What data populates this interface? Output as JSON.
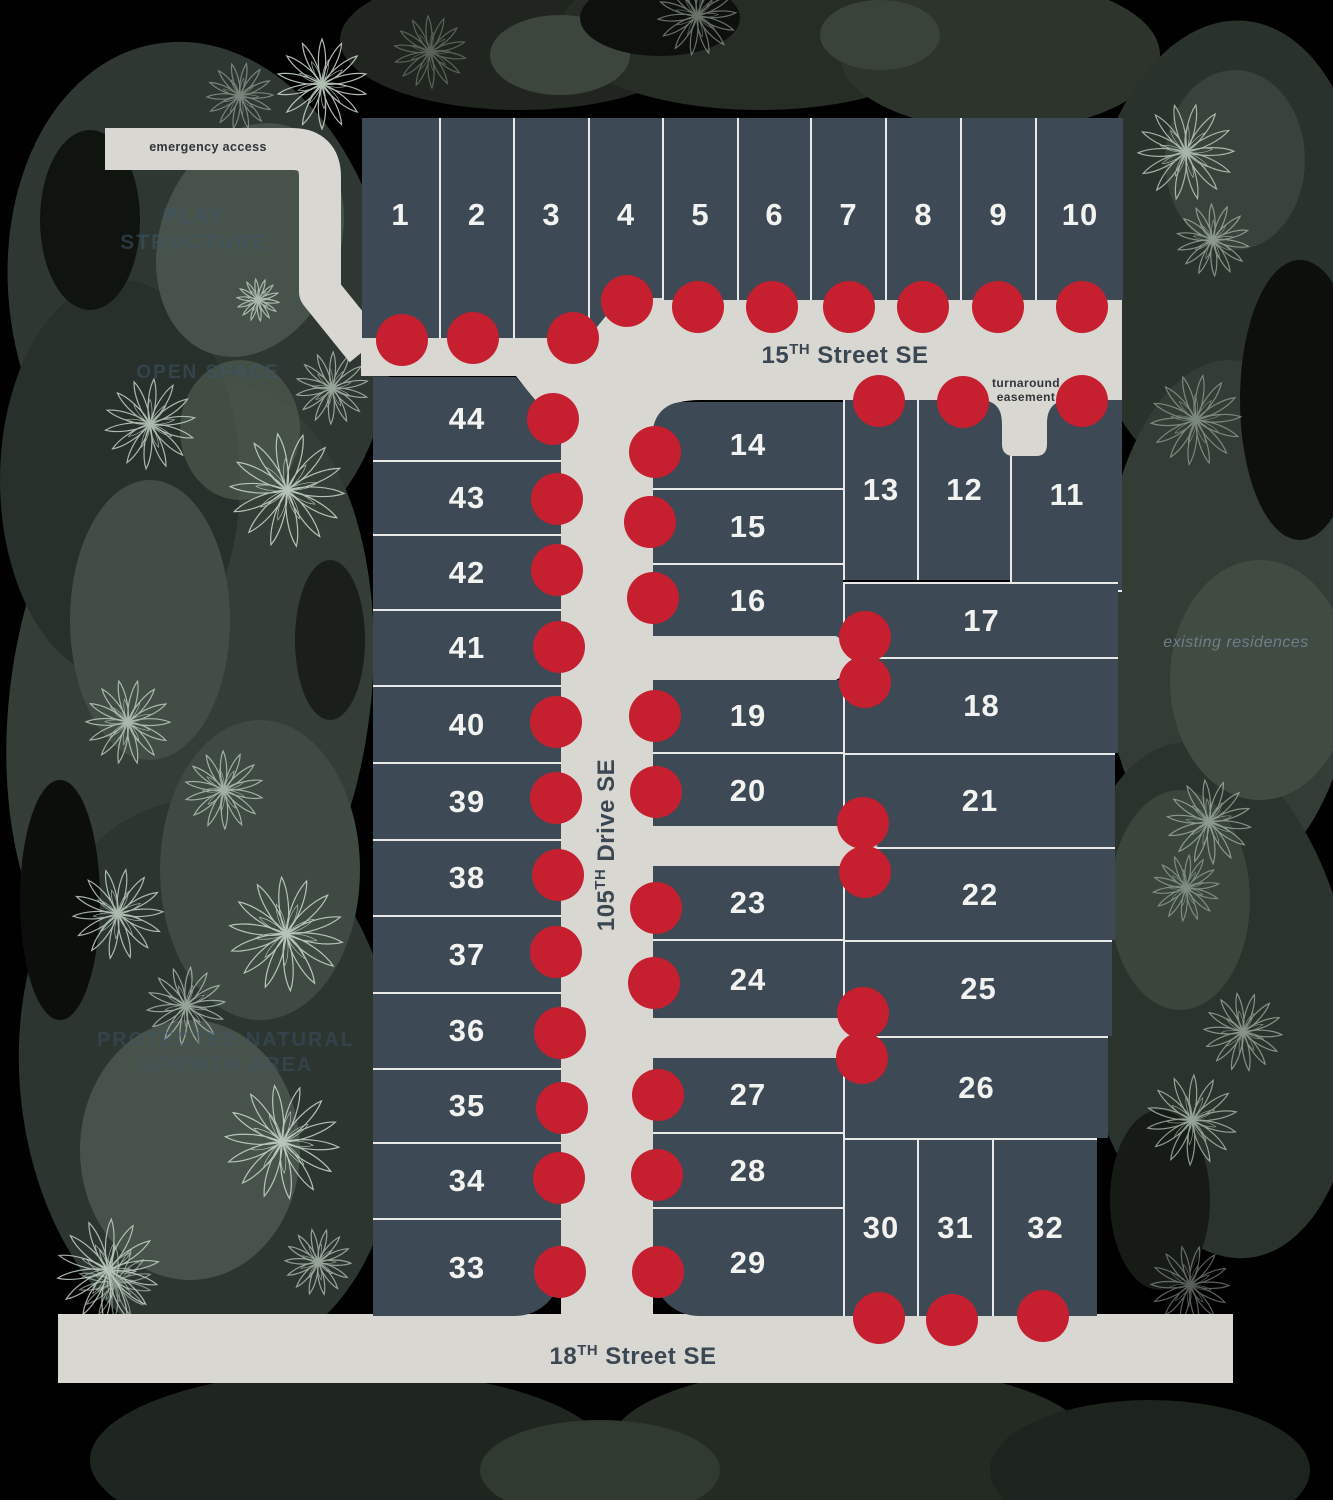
{
  "title": "community site plan",
  "colors": {
    "background": "#000000",
    "lot_fill": "#3d4954",
    "divider_line": "#e9eae7",
    "street": "#d9d7d2",
    "marker_dot": "#c51f30",
    "lot_number_text": "#f2f3f1",
    "street_label_text": "#3b4853",
    "faint_label_text": "#3e566c",
    "tree_stroke": "#c3d3c5"
  },
  "labels": {
    "emergency_access": "emergency access",
    "play_structure": "PLAY STRUCTURE",
    "open_space": "OPEN SPACE",
    "protected_area": "PROTECTED NATURAL GROWTH AREA",
    "turnaround_easement": "turnaround easement",
    "existing_residences": "existing residences"
  },
  "street_labels": {
    "s15": {
      "pre": "15",
      "sup": "TH",
      "post": " Street SE"
    },
    "d105": {
      "pre": "105",
      "sup": "TH",
      "post": " Drive SE"
    },
    "s18": {
      "pre": "18",
      "sup": "TH",
      "post": " Street SE"
    }
  },
  "lots": [
    {
      "n": 1,
      "x": 362,
      "y": 118,
      "w": 77,
      "h": 220,
      "b": "",
      "dot": [
        402,
        340
      ],
      "dy": -13
    },
    {
      "n": 2,
      "x": 439,
      "y": 118,
      "w": 74,
      "h": 220,
      "b": "l",
      "dot": [
        473,
        338
      ],
      "dy": -13
    },
    {
      "n": 3,
      "x": 513,
      "y": 118,
      "w": 75,
      "h": 220,
      "b": "l",
      "dot": [
        573,
        338
      ],
      "dy": -13
    },
    {
      "n": 4,
      "x": 588,
      "y": 118,
      "w": 74,
      "h": 220,
      "b": "l",
      "dot": [
        627,
        301
      ],
      "dy": -13,
      "clip": "polygon(0% 0%,100% 0%,100% 81.8%,44% 81.8%,0% 100%)"
    },
    {
      "n": 5,
      "x": 662,
      "y": 118,
      "w": 75,
      "h": 182,
      "b": "l",
      "dot": [
        698,
        307
      ],
      "dy": 6
    },
    {
      "n": 6,
      "x": 737,
      "y": 118,
      "w": 73,
      "h": 182,
      "b": "l",
      "dot": [
        772,
        307
      ],
      "dy": 6
    },
    {
      "n": 7,
      "x": 810,
      "y": 118,
      "w": 75,
      "h": 182,
      "b": "l",
      "dot": [
        849,
        307
      ],
      "dy": 6
    },
    {
      "n": 8,
      "x": 885,
      "y": 118,
      "w": 75,
      "h": 182,
      "b": "l",
      "dot": [
        923,
        307
      ],
      "dy": 6
    },
    {
      "n": 9,
      "x": 960,
      "y": 118,
      "w": 75,
      "h": 182,
      "b": "l",
      "dot": [
        998,
        307
      ],
      "dy": 6
    },
    {
      "n": 10,
      "x": 1035,
      "y": 118,
      "w": 88,
      "h": 182,
      "b": "l",
      "dot": [
        1082,
        307
      ],
      "dy": 6
    },
    {
      "n": 13,
      "x": 843,
      "y": 400,
      "w": 74,
      "h": 180,
      "b": "l",
      "dot": [
        879,
        401
      ]
    },
    {
      "n": 12,
      "x": 917,
      "y": 400,
      "w": 93,
      "h": 180,
      "b": "l",
      "dot": [
        963,
        402
      ]
    },
    {
      "n": 11,
      "x": 1010,
      "y": 400,
      "w": 112,
      "h": 192,
      "b": "lb",
      "dot": [
        1082,
        401
      ]
    },
    {
      "n": 14,
      "x": 653,
      "y": 402,
      "w": 190,
      "h": 86,
      "b": "",
      "dot": [
        655,
        452
      ],
      "r": "tl"
    },
    {
      "n": 15,
      "x": 653,
      "y": 488,
      "w": 190,
      "h": 75,
      "b": "t",
      "dot": [
        650,
        522
      ]
    },
    {
      "n": 16,
      "x": 653,
      "y": 563,
      "w": 190,
      "h": 74,
      "b": "t",
      "dot": [
        653,
        598
      ]
    },
    {
      "n": 17,
      "x": 843,
      "y": 582,
      "w": 275,
      "h": 75,
      "b": "tl",
      "dot": [
        865,
        637
      ]
    },
    {
      "n": 18,
      "x": 843,
      "y": 657,
      "w": 275,
      "h": 96,
      "b": "tl",
      "dot": [
        865,
        682
      ]
    },
    {
      "n": 19,
      "x": 653,
      "y": 680,
      "w": 190,
      "h": 72,
      "b": "",
      "dot": [
        655,
        716
      ]
    },
    {
      "n": 20,
      "x": 653,
      "y": 752,
      "w": 190,
      "h": 75,
      "b": "t",
      "dot": [
        656,
        792
      ]
    },
    {
      "n": 21,
      "x": 843,
      "y": 753,
      "w": 272,
      "h": 94,
      "b": "tl",
      "dot": [
        863,
        823
      ]
    },
    {
      "n": 22,
      "x": 843,
      "y": 847,
      "w": 272,
      "h": 93,
      "b": "tl",
      "dot": [
        865,
        872
      ]
    },
    {
      "n": 23,
      "x": 653,
      "y": 866,
      "w": 190,
      "h": 73,
      "b": "",
      "dot": [
        656,
        908
      ]
    },
    {
      "n": 24,
      "x": 653,
      "y": 939,
      "w": 190,
      "h": 79,
      "b": "t",
      "dot": [
        654,
        983
      ]
    },
    {
      "n": 25,
      "x": 843,
      "y": 940,
      "w": 269,
      "h": 96,
      "b": "tl",
      "dot": [
        863,
        1013
      ]
    },
    {
      "n": 26,
      "x": 843,
      "y": 1036,
      "w": 265,
      "h": 102,
      "b": "tl",
      "dot": [
        862,
        1058
      ]
    },
    {
      "n": 27,
      "x": 653,
      "y": 1057,
      "w": 190,
      "h": 75,
      "b": "",
      "dot": [
        658,
        1095
      ]
    },
    {
      "n": 28,
      "x": 653,
      "y": 1132,
      "w": 190,
      "h": 75,
      "b": "t",
      "dot": [
        657,
        1175
      ]
    },
    {
      "n": 29,
      "x": 653,
      "y": 1207,
      "w": 190,
      "h": 109,
      "b": "t",
      "dot": [
        658,
        1272
      ],
      "r": "bl"
    },
    {
      "n": 30,
      "x": 843,
      "y": 1138,
      "w": 74,
      "h": 178,
      "b": "tl",
      "dot": [
        879,
        1318
      ]
    },
    {
      "n": 31,
      "x": 917,
      "y": 1138,
      "w": 75,
      "h": 178,
      "b": "tl",
      "dot": [
        952,
        1320
      ]
    },
    {
      "n": 32,
      "x": 992,
      "y": 1138,
      "w": 105,
      "h": 178,
      "b": "tl",
      "dot": [
        1043,
        1316
      ]
    },
    {
      "n": 44,
      "x": 373,
      "y": 377,
      "w": 188,
      "h": 83,
      "b": "",
      "dot": [
        553,
        419
      ],
      "clip": "polygon(0% 0%,76% 0%,100% 64%,100% 100%,0% 100%)"
    },
    {
      "n": 43,
      "x": 373,
      "y": 460,
      "w": 188,
      "h": 74,
      "b": "t",
      "dot": [
        557,
        499
      ]
    },
    {
      "n": 42,
      "x": 373,
      "y": 534,
      "w": 188,
      "h": 75,
      "b": "t",
      "dot": [
        557,
        570
      ]
    },
    {
      "n": 41,
      "x": 373,
      "y": 609,
      "w": 188,
      "h": 76,
      "b": "t",
      "dot": [
        559,
        647
      ]
    },
    {
      "n": 40,
      "x": 373,
      "y": 685,
      "w": 188,
      "h": 77,
      "b": "t",
      "dot": [
        556,
        722
      ]
    },
    {
      "n": 39,
      "x": 373,
      "y": 762,
      "w": 188,
      "h": 77,
      "b": "t",
      "dot": [
        556,
        798
      ]
    },
    {
      "n": 38,
      "x": 373,
      "y": 839,
      "w": 188,
      "h": 76,
      "b": "t",
      "dot": [
        558,
        875
      ]
    },
    {
      "n": 37,
      "x": 373,
      "y": 915,
      "w": 188,
      "h": 77,
      "b": "t",
      "dot": [
        556,
        952
      ]
    },
    {
      "n": 36,
      "x": 373,
      "y": 992,
      "w": 188,
      "h": 76,
      "b": "t",
      "dot": [
        560,
        1033
      ]
    },
    {
      "n": 35,
      "x": 373,
      "y": 1068,
      "w": 188,
      "h": 74,
      "b": "t",
      "dot": [
        562,
        1108
      ]
    },
    {
      "n": 34,
      "x": 373,
      "y": 1142,
      "w": 188,
      "h": 76,
      "b": "t",
      "dot": [
        559,
        1178
      ]
    },
    {
      "n": 33,
      "x": 373,
      "y": 1218,
      "w": 188,
      "h": 98,
      "b": "t",
      "dot": [
        560,
        1272
      ],
      "r": "br"
    }
  ],
  "trees": [
    {
      "x": 322,
      "y": 84,
      "s": 1.5,
      "o": 0.9
    },
    {
      "x": 240,
      "y": 96,
      "s": 1.1,
      "o": 0.5
    },
    {
      "x": 430,
      "y": 52,
      "s": 1.2,
      "o": 0.35
    },
    {
      "x": 697,
      "y": 16,
      "s": 1.3,
      "o": 0.5
    },
    {
      "x": 258,
      "y": 300,
      "s": 0.7,
      "o": 0.8
    },
    {
      "x": 150,
      "y": 424,
      "s": 1.5,
      "o": 0.85
    },
    {
      "x": 287,
      "y": 490,
      "s": 1.9,
      "o": 0.9
    },
    {
      "x": 332,
      "y": 388,
      "s": 1.2,
      "o": 0.7
    },
    {
      "x": 128,
      "y": 722,
      "s": 1.4,
      "o": 0.8
    },
    {
      "x": 224,
      "y": 790,
      "s": 1.3,
      "o": 0.75
    },
    {
      "x": 118,
      "y": 914,
      "s": 1.5,
      "o": 0.85
    },
    {
      "x": 286,
      "y": 934,
      "s": 1.9,
      "o": 0.9
    },
    {
      "x": 186,
      "y": 1006,
      "s": 1.3,
      "o": 0.7
    },
    {
      "x": 282,
      "y": 1142,
      "s": 1.9,
      "o": 0.9
    },
    {
      "x": 108,
      "y": 1270,
      "s": 1.7,
      "o": 0.85
    },
    {
      "x": 318,
      "y": 1262,
      "s": 1.1,
      "o": 0.7
    },
    {
      "x": 115,
      "y": 1282,
      "s": 1.2,
      "o": 0.6
    },
    {
      "x": 1186,
      "y": 152,
      "s": 1.6,
      "o": 0.8
    },
    {
      "x": 1213,
      "y": 240,
      "s": 1.2,
      "o": 0.6
    },
    {
      "x": 1196,
      "y": 420,
      "s": 1.5,
      "o": 0.5
    },
    {
      "x": 1209,
      "y": 822,
      "s": 1.4,
      "o": 0.6
    },
    {
      "x": 1186,
      "y": 888,
      "s": 1.1,
      "o": 0.5
    },
    {
      "x": 1243,
      "y": 1032,
      "s": 1.3,
      "o": 0.6
    },
    {
      "x": 1192,
      "y": 1120,
      "s": 1.5,
      "o": 0.7
    },
    {
      "x": 1190,
      "y": 1285,
      "s": 1.3,
      "o": 0.45
    }
  ]
}
